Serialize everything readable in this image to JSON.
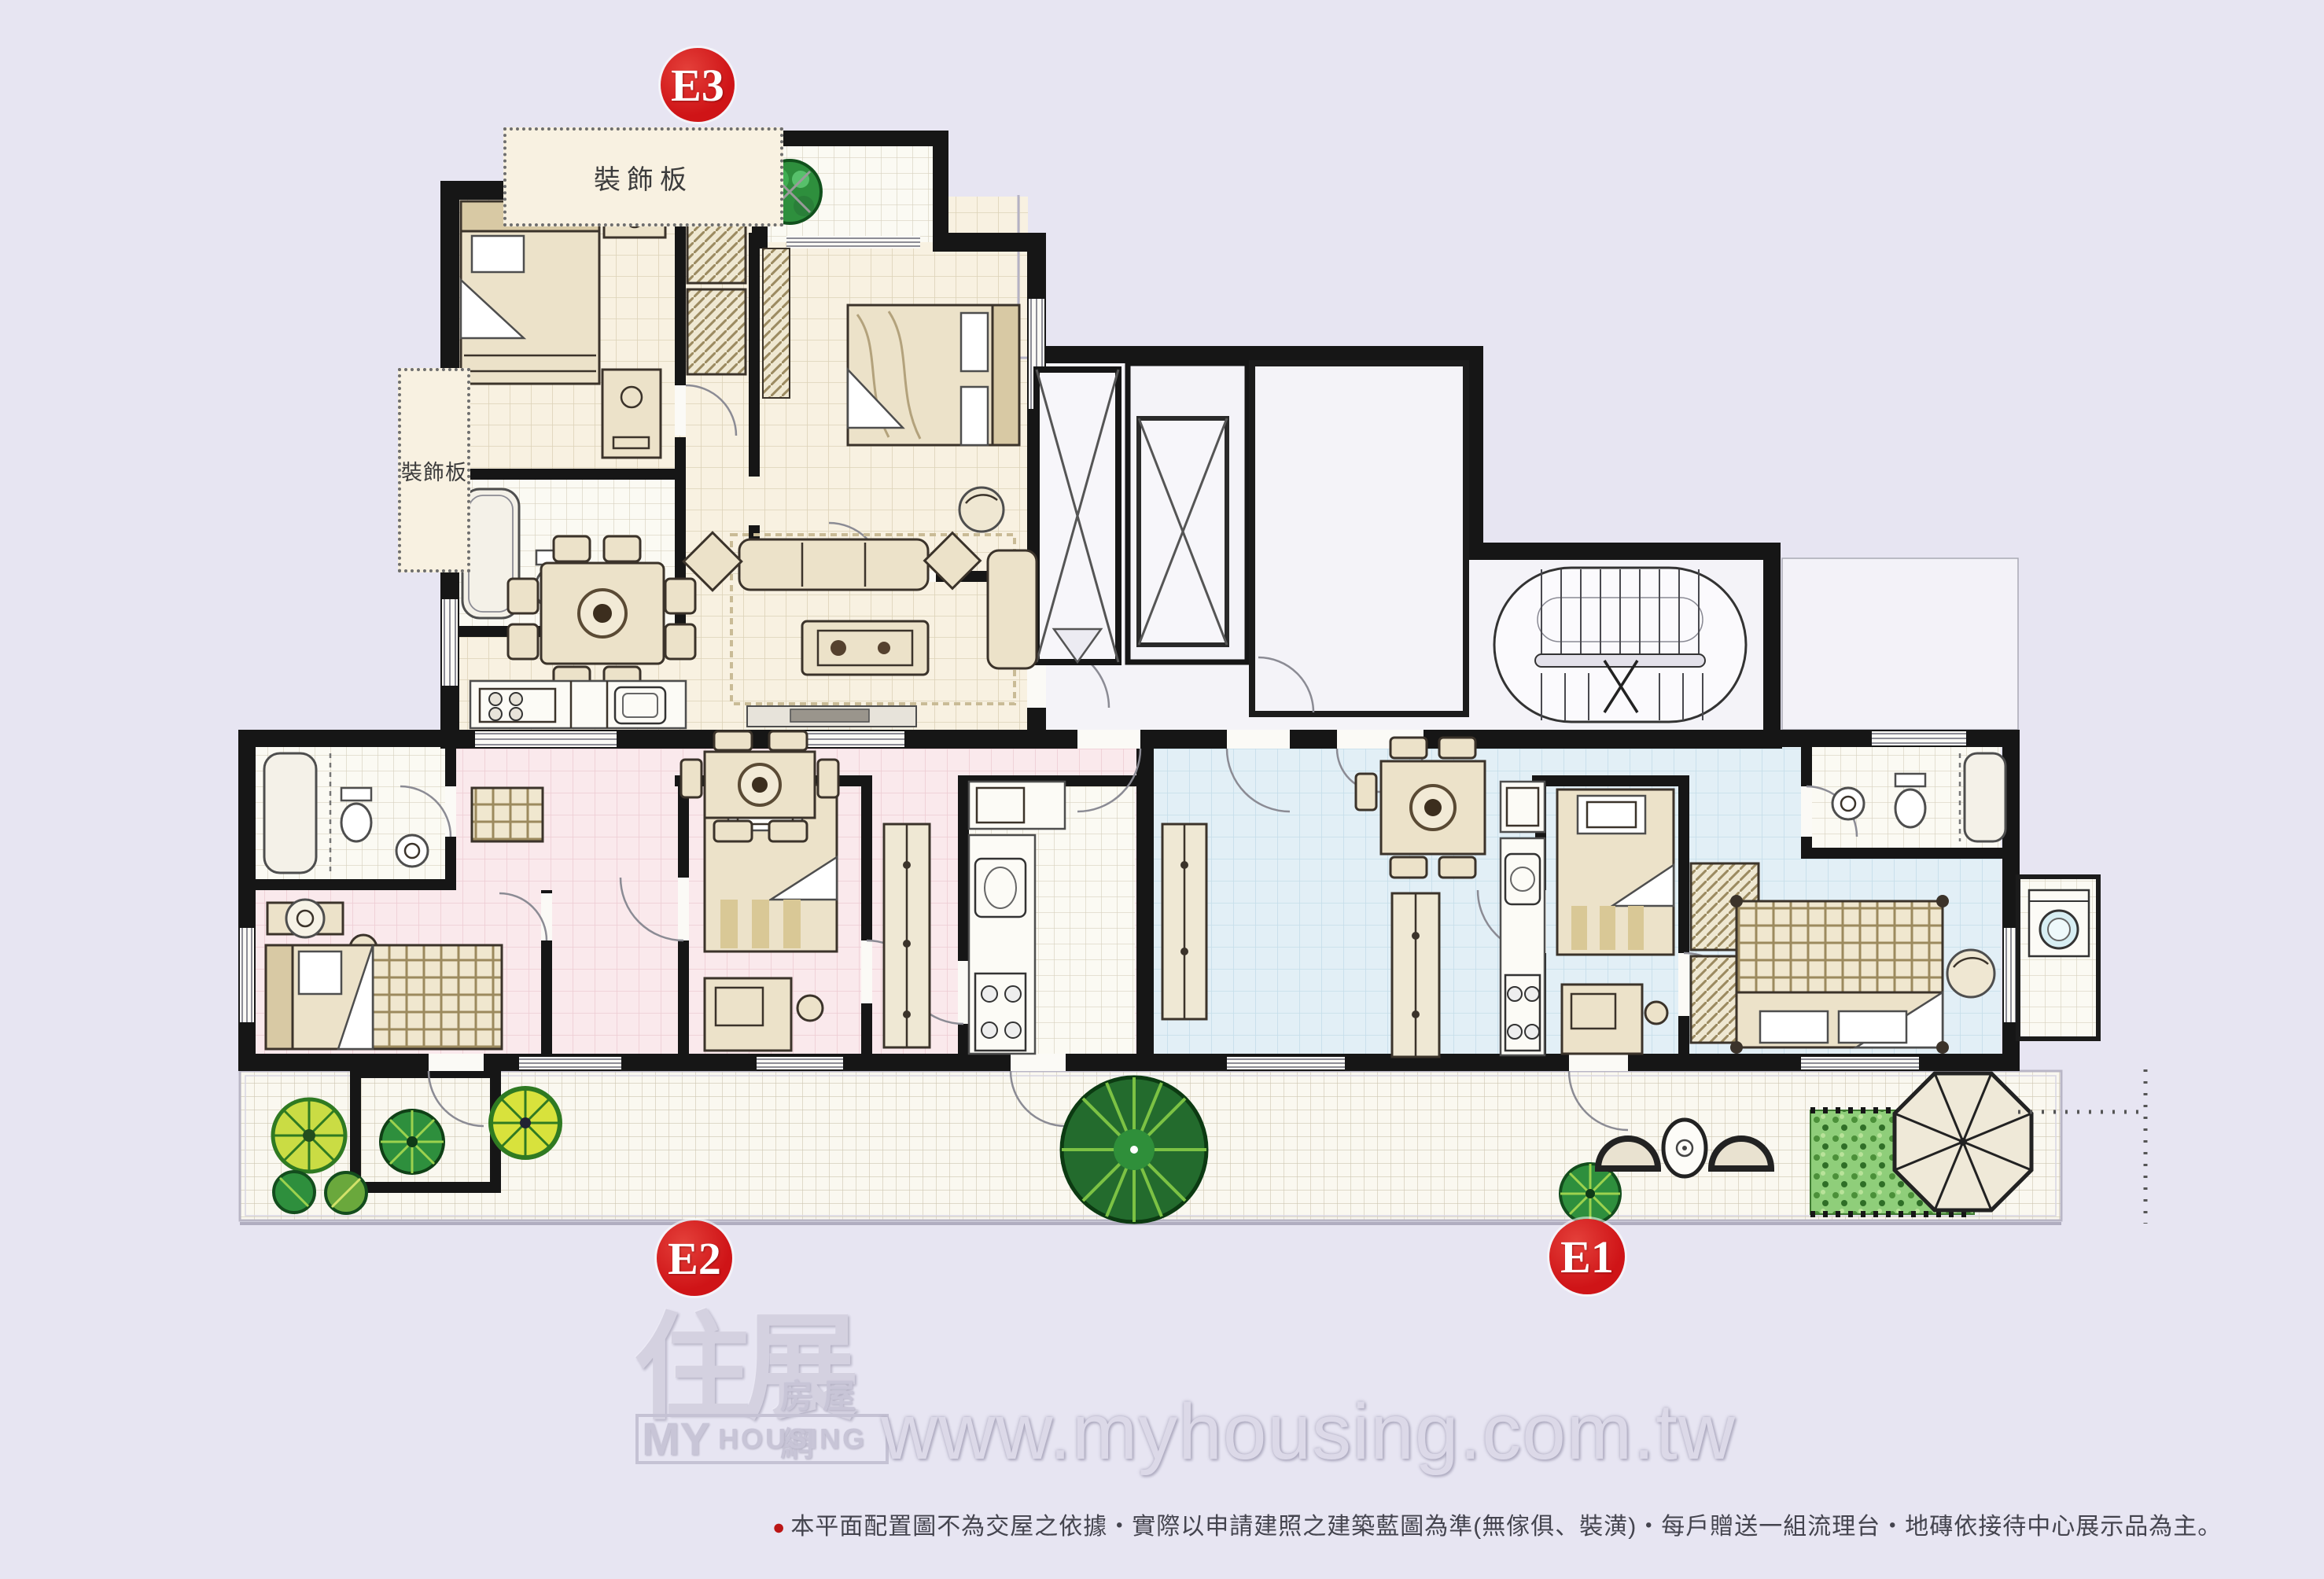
{
  "units": [
    {
      "id": "E1",
      "label": "E1"
    },
    {
      "id": "E2",
      "label": "E2"
    },
    {
      "id": "E3",
      "label": "E3"
    }
  ],
  "annotations": {
    "decor_panel_top": "裝飾板",
    "decor_panel_left": "裝飾板"
  },
  "watermark": {
    "brand_zh": "住展",
    "brand_sub": "房屋網",
    "brand_en_line1": "MY",
    "brand_en_line2": "HOUSING",
    "url": "www.myhousing.com.tw"
  },
  "disclaimer": {
    "bullet": "●",
    "text": "本平面配置圖不為交屋之依據・實際以申請建照之建築藍圖為準(無傢俱、裝潢)・每戶贈送一組流理台・地磚依接待中心展示品為主。"
  },
  "colors": {
    "background": "#e7e5f2",
    "wall": "#161616",
    "badge_red": "#cf1417",
    "badge_text": "#ffffff",
    "floor_e3": "#f8f1e1",
    "floor_e2": "#fae9ec",
    "floor_e1": "#e2eff6",
    "floor_bath": "#fbfaf3",
    "floor_terrace": "#faf8f0",
    "floor_core": "#f4f3f8",
    "grid_e3": "#dcd2b8",
    "grid_e2": "#edccd3",
    "grid_e1": "#c4dde9",
    "grid_bath": "#d8d2c0",
    "grid_terrace": "#cec7b2",
    "furniture_fill": "#ece2c9",
    "furniture_line": "#3b332a",
    "tree_dark": "#236b2d",
    "tree_light": "#7cc244",
    "tree_yellow": "#d8e23c",
    "hedge_green": "#8fce7a",
    "watermark_gray": "#c9c6d8",
    "url_gray": "#dcd9e8",
    "disclaimer_text": "#44444e",
    "disclaimer_bullet": "#bb1515"
  }
}
